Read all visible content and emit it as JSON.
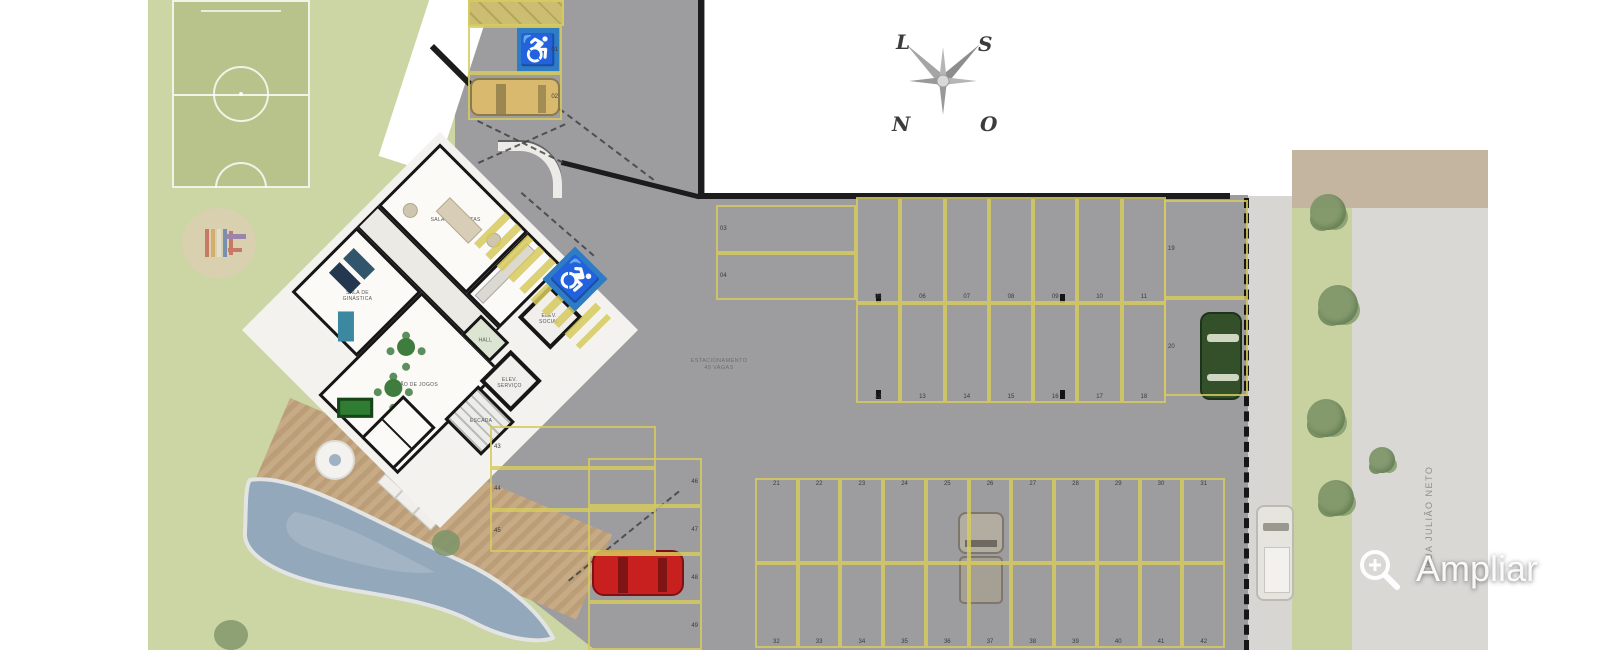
{
  "compass": {
    "top_left": "L",
    "top_right": "S",
    "bottom_left": "N",
    "bottom_right": "O"
  },
  "zoom_control": {
    "label": "Ampliar",
    "icon": "magnifier-plus-icon"
  },
  "street": {
    "name": "RUA JULIÃO NETO"
  },
  "parking": {
    "center_label_line1": "ESTACIONAMENTO",
    "center_label_line2": "49 VAGAS",
    "stall_groups": {
      "entry": [
        "01",
        "02"
      ],
      "top_horizontal": [
        "03",
        "04"
      ],
      "top_row": [
        "05",
        "06",
        "07",
        "08",
        "09",
        "10",
        "11"
      ],
      "mid_row": [
        "12",
        "13",
        "14",
        "15",
        "16",
        "17",
        "18"
      ],
      "right_column": [
        "19",
        "20"
      ],
      "bottom_upper": [
        "21",
        "22",
        "23",
        "24",
        "25",
        "26",
        "27",
        "28",
        "29",
        "30",
        "31"
      ],
      "bottom_lower": [
        "32",
        "33",
        "34",
        "35",
        "36",
        "37",
        "38",
        "39",
        "40",
        "41",
        "42"
      ],
      "west_rows": [
        "43",
        "44",
        "45"
      ],
      "southwest_rows": [
        "46",
        "47",
        "48",
        "49"
      ]
    }
  },
  "building": {
    "rooms": {
      "party": "SALÃO DE FESTAS",
      "gym": "SALA DE GINÁSTICA",
      "games": "SALÃO DE JOGOS",
      "elev_social": "ELEV. SOCIAL",
      "elev_servico": "ELEV. SERVIÇO",
      "hall": "HALL",
      "stairs": "ESCADA"
    }
  },
  "colors": {
    "handicap_blue": "#2f7cc4",
    "stall_yellow": "#d6ca5e",
    "lawn": "#ccd5a4",
    "pavement": "#9d9da0",
    "pool": "#93a8bb",
    "car_red": "#c81f1f",
    "car_yellow": "#d9b96d",
    "car_green": "#33502a"
  }
}
